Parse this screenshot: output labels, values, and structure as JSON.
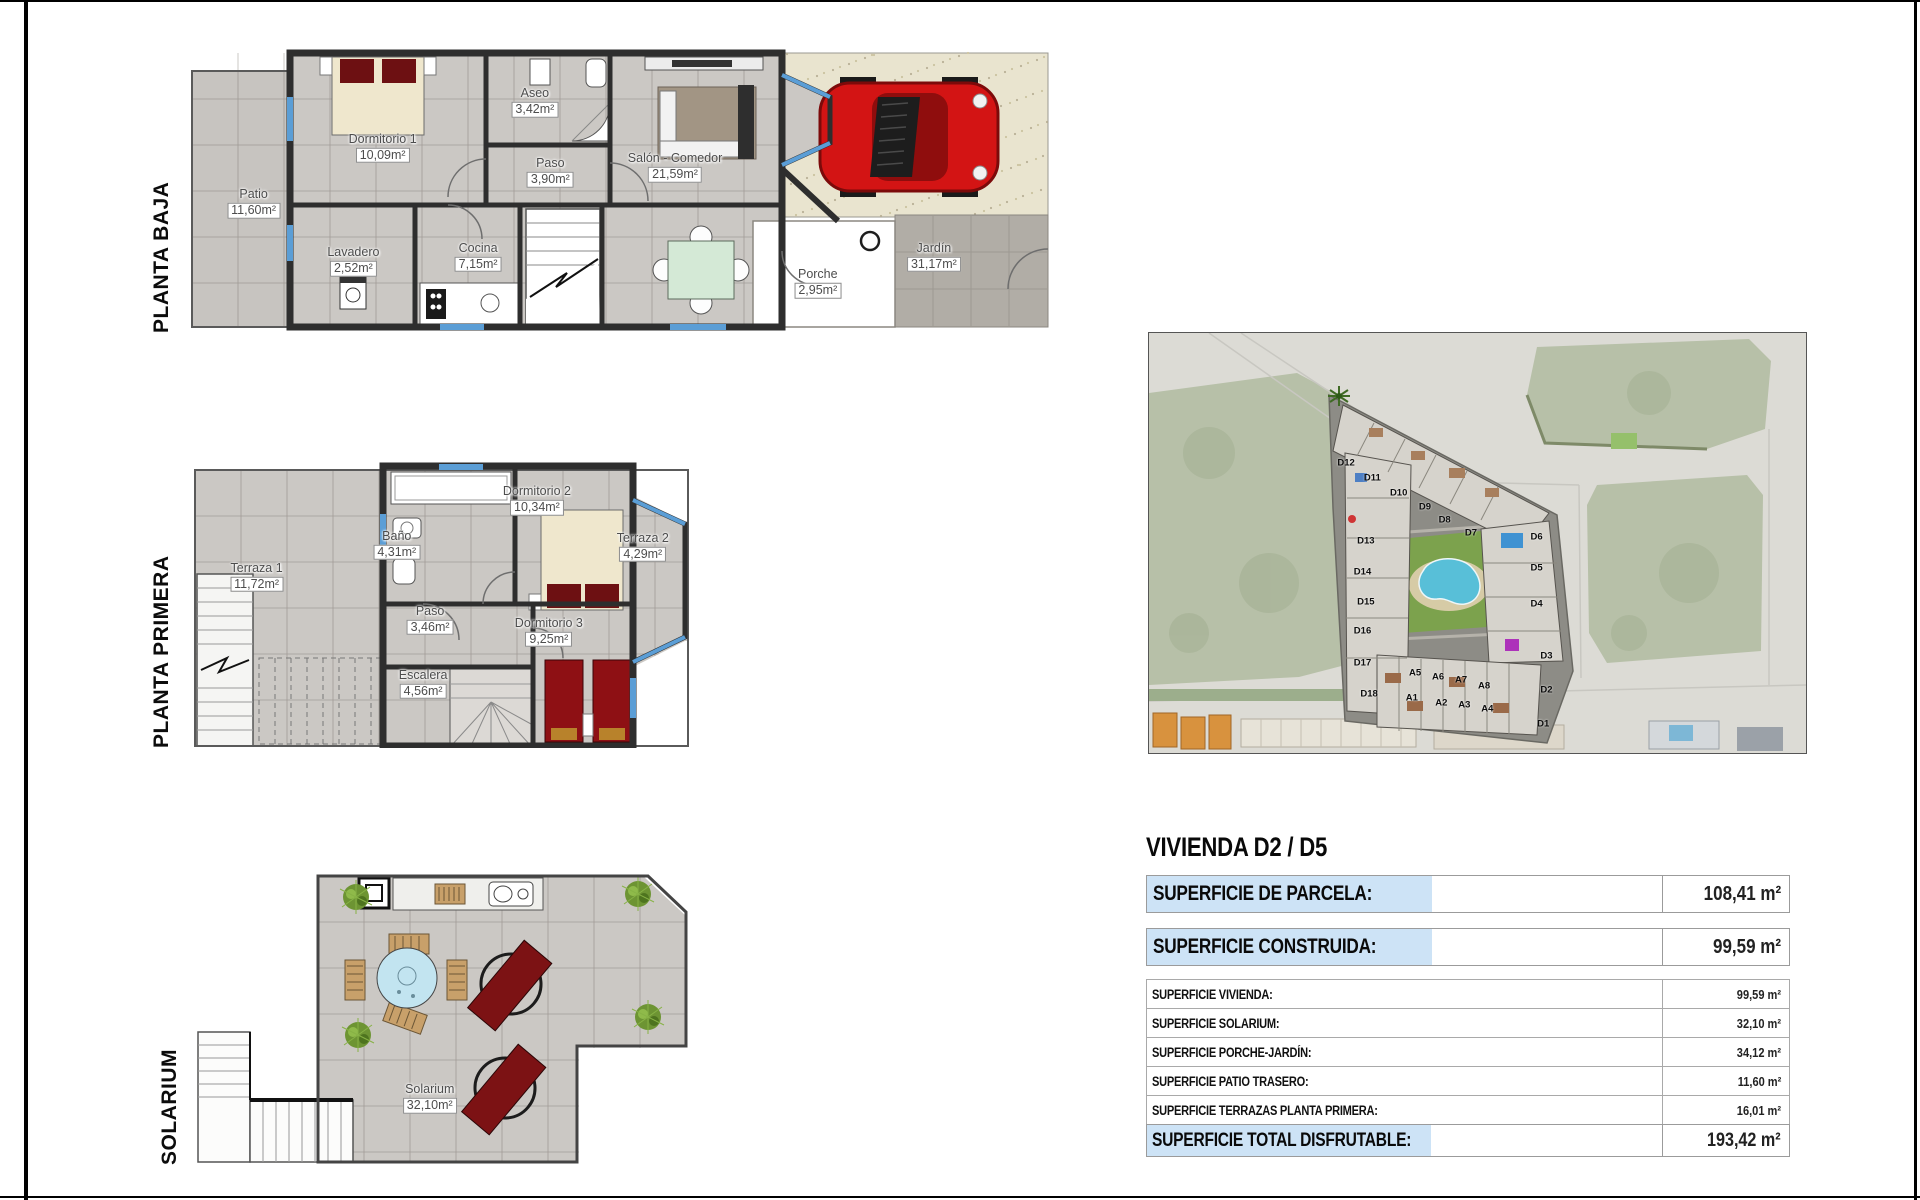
{
  "floors": {
    "baja": {
      "label": "PLANTA BAJA",
      "rooms": [
        {
          "name": "Patio",
          "area": "11,60m²",
          "x": 7.4,
          "y": 54.5
        },
        {
          "name": "Dormitorio 1",
          "area": "10,09m²",
          "x": 22.4,
          "y": 35.5
        },
        {
          "name": "Aseo",
          "area": "3,42m²",
          "x": 40.1,
          "y": 19.7
        },
        {
          "name": "Paso",
          "area": "3,90m²",
          "x": 41.9,
          "y": 43.8
        },
        {
          "name": "Salón - Comedor",
          "area": "21,59m²",
          "x": 56.4,
          "y": 42.1
        },
        {
          "name": "Lavadero",
          "area": "2,52m²",
          "x": 19.0,
          "y": 74.5
        },
        {
          "name": "Cocina",
          "area": "7,15m²",
          "x": 33.5,
          "y": 73.1
        },
        {
          "name": "Porche",
          "area": "2,95m²",
          "x": 73.0,
          "y": 82.1
        },
        {
          "name": "Jardín",
          "area": "31,17m²",
          "x": 86.5,
          "y": 73.1
        }
      ]
    },
    "primera": {
      "label": "PLANTA PRIMERA",
      "rooms": [
        {
          "name": "Terraza 1",
          "area": "11,72m²",
          "x": 12.8,
          "y": 40.2
        },
        {
          "name": "Baño",
          "area": "4,31m²",
          "x": 41.0,
          "y": 29.0
        },
        {
          "name": "Dormitorio 2",
          "area": "10,34m²",
          "x": 69.2,
          "y": 13.3
        },
        {
          "name": "Terraza 2",
          "area": "4,29m²",
          "x": 90.5,
          "y": 29.7
        },
        {
          "name": "Paso",
          "area": "3,46m²",
          "x": 47.7,
          "y": 55.2
        },
        {
          "name": "Escalera",
          "area": "4,56m²",
          "x": 46.3,
          "y": 77.6
        },
        {
          "name": "Dormitorio 3",
          "area": "9,25m²",
          "x": 71.6,
          "y": 59.4
        }
      ]
    },
    "solarium": {
      "label": "SOLARIUM",
      "rooms": [
        {
          "name": "Solarium",
          "area": "32,10m²",
          "x": 44.5,
          "y": 76.5
        }
      ]
    }
  },
  "map": {
    "building_labels": [
      {
        "t": "D12",
        "x": 30,
        "y": 31
      },
      {
        "t": "D11",
        "x": 34,
        "y": 34.5
      },
      {
        "t": "D10",
        "x": 38,
        "y": 38
      },
      {
        "t": "D9",
        "x": 42,
        "y": 41.5
      },
      {
        "t": "D8",
        "x": 45,
        "y": 44.5
      },
      {
        "t": "D7",
        "x": 49,
        "y": 47.5
      },
      {
        "t": "D13",
        "x": 33,
        "y": 49.5
      },
      {
        "t": "D14",
        "x": 32.5,
        "y": 57
      },
      {
        "t": "D15",
        "x": 33,
        "y": 64
      },
      {
        "t": "D16",
        "x": 32.5,
        "y": 71
      },
      {
        "t": "D17",
        "x": 32.5,
        "y": 78.5
      },
      {
        "t": "D18",
        "x": 33.5,
        "y": 86
      },
      {
        "t": "D6",
        "x": 59,
        "y": 48.5
      },
      {
        "t": "D5",
        "x": 59,
        "y": 56
      },
      {
        "t": "D4",
        "x": 59,
        "y": 64.5
      },
      {
        "t": "D3",
        "x": 60.5,
        "y": 77
      },
      {
        "t": "D2",
        "x": 60.5,
        "y": 85
      },
      {
        "t": "D1",
        "x": 60,
        "y": 93
      },
      {
        "t": "A5",
        "x": 40.5,
        "y": 81
      },
      {
        "t": "A6",
        "x": 44,
        "y": 82
      },
      {
        "t": "A7",
        "x": 47.5,
        "y": 82.5
      },
      {
        "t": "A8",
        "x": 51,
        "y": 84
      },
      {
        "t": "A1",
        "x": 40,
        "y": 87
      },
      {
        "t": "A2",
        "x": 44.5,
        "y": 88
      },
      {
        "t": "A3",
        "x": 48,
        "y": 88.5
      },
      {
        "t": "A4",
        "x": 51.5,
        "y": 89.5
      }
    ]
  },
  "summary": {
    "title": "VIVIENDA D2 / D5",
    "rows_big": [
      {
        "label": "SUPERFICIE DE PARCELA:",
        "value": "108,41 m²"
      },
      {
        "label": "SUPERFICIE CONSTRUIDA:",
        "value": "99,59 m²"
      }
    ],
    "rows_small": [
      {
        "label": "SUPERFICIE VIVIENDA:",
        "value": "99,59 m²"
      },
      {
        "label": "SUPERFICIE SOLARIUM:",
        "value": "32,10 m²"
      },
      {
        "label": "SUPERFICIE PORCHE-JARDÍN:",
        "value": "34,12 m²"
      },
      {
        "label": "SUPERFICIE PATIO TRASERO:",
        "value": "11,60 m²"
      },
      {
        "label": "SUPERFICIE TERRAZAS PLANTA PRIMERA:",
        "value": "16,01 m²"
      }
    ],
    "row_total": {
      "label": "SUPERFICIE TOTAL DISFRUTABLE:",
      "value": "193,42 m²"
    }
  },
  "colors": {
    "highlight_blue": "#cde3f6",
    "wall_dark": "#2e2e2e",
    "floor_tile": "#cbc8c4",
    "window_blue": "#5b9ed6",
    "bed_cream": "#efe7cd",
    "bed_red": "#6d1012",
    "car_red": "#d31414",
    "pool_blue": "#58bfd8",
    "lawn_green": "#7ca24d"
  }
}
